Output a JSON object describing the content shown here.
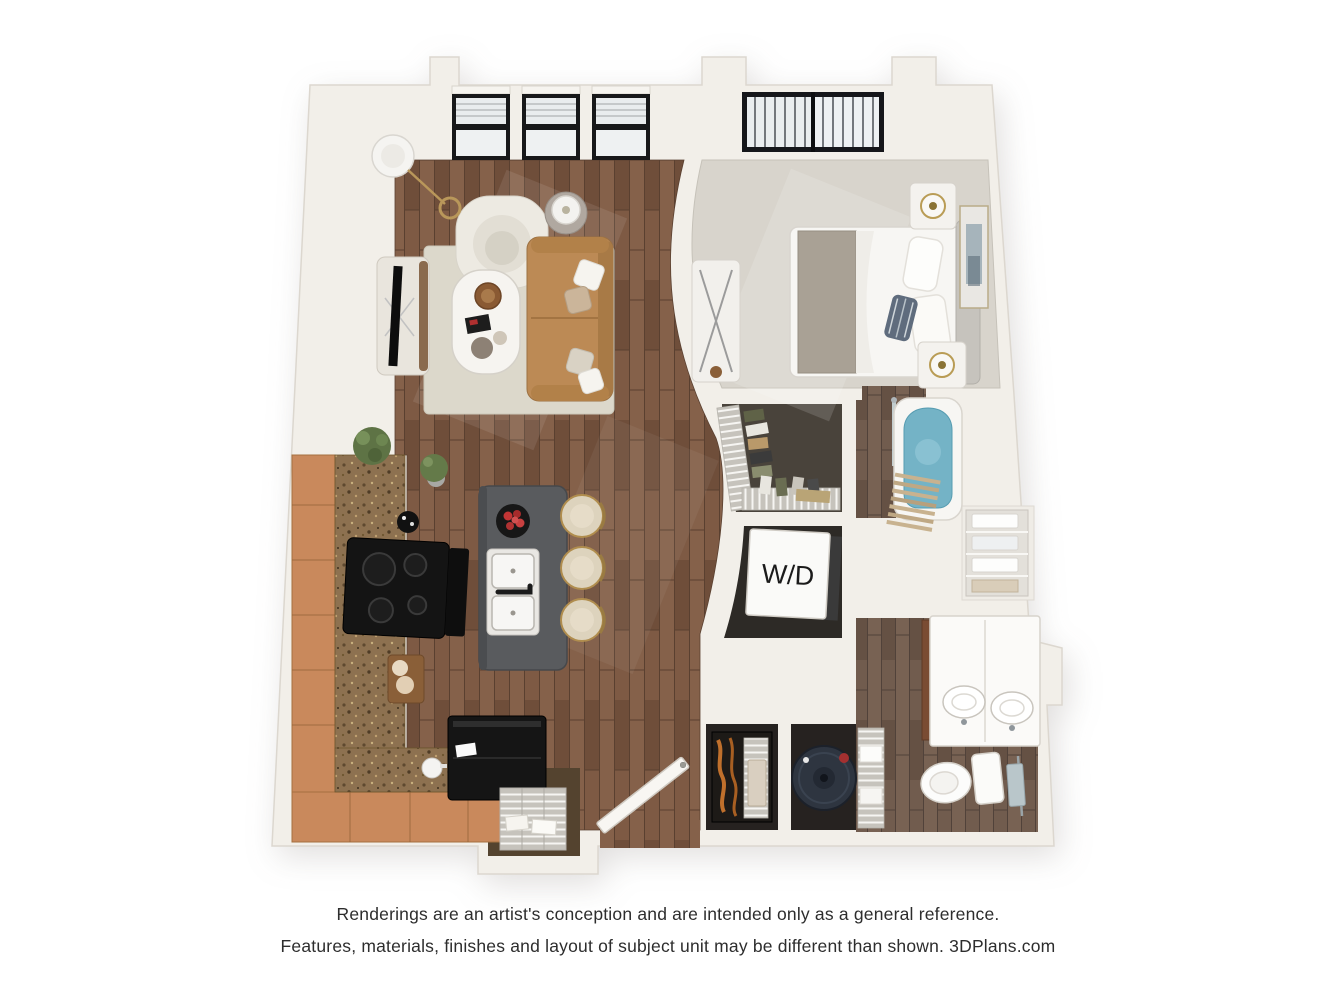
{
  "plan": {
    "labels": {
      "washer_dryer": "W/D"
    },
    "colors": {
      "background": "#ffffff",
      "wall": "#f2efe9",
      "wall_edge": "#dcd7cf",
      "wood_floor": "#7b5843",
      "bath_floor": "#6e594b",
      "bedroom_carpet": "#d8d4cc",
      "closet_carpet": "#49433b",
      "kitchen_cabinet": "#c9895c",
      "granite_counter": "#8d7150",
      "island_top": "#595b5e",
      "sofa_leather": "#bc8a55",
      "stool_seat": "#ddd3bd",
      "tub_water": "#74b3c6",
      "window_frame": "#17181a",
      "appliance_black": "#151515",
      "water_heater": "#2e3540",
      "text": "#2d2d2d"
    }
  },
  "footer": {
    "line1": "Renderings are an artist's conception and are intended only as a general reference.",
    "line2": "Features, materials, finishes and layout of subject unit may be different than shown. 3DPlans.com"
  }
}
